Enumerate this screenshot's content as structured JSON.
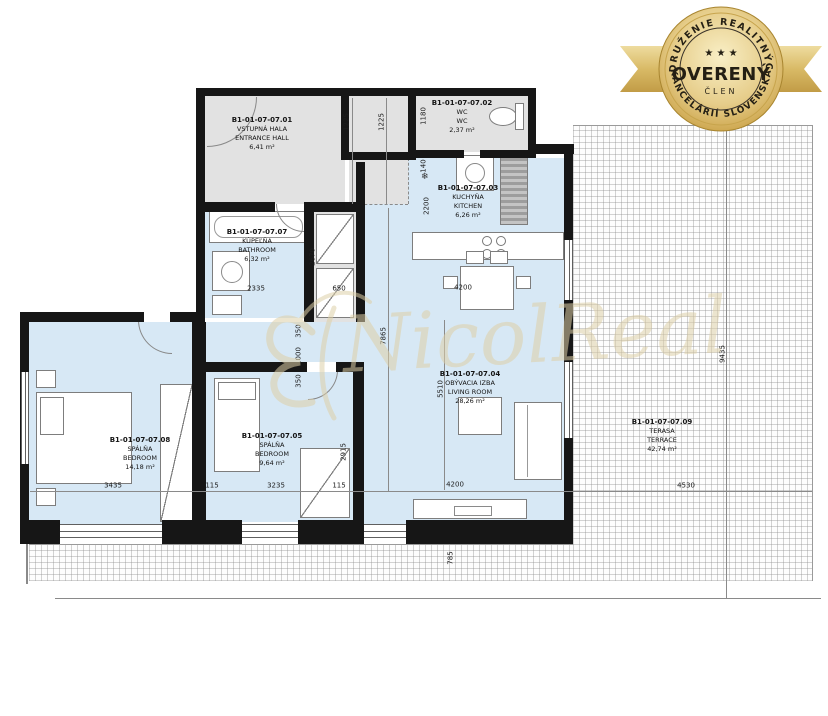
{
  "badge": {
    "arc_top": "ZDRUŽENIE REALITNÝCH",
    "arc_bottom": "KANCELÁRIÍ SLOVENSKA",
    "stars": "★ ★ ★",
    "title": "OVERENÝ",
    "subtitle": "ČLEN"
  },
  "watermark": {
    "text": "NicolReal"
  },
  "icons": {
    "fridge_snowflake": "❄"
  },
  "rooms": [
    {
      "code": "B1-01-07-07.01",
      "name_sk": "VSTUPNÁ HALA",
      "name_en": "ENTRANCE HALL",
      "area": "6,41 m²"
    },
    {
      "code": "B1-01-07-07.02",
      "name_sk": "WC",
      "name_en": "WC",
      "area": "2,37 m²"
    },
    {
      "code": "B1-01-07-07.03",
      "name_sk": "KUCHYŇA",
      "name_en": "KITCHEN",
      "area": "6,26 m²"
    },
    {
      "code": "B1-01-07-07.04",
      "name_sk": "OBÝVACIA IZBA",
      "name_en": "LIVING ROOM",
      "area": "28,26 m²"
    },
    {
      "code": "B1-01-07-07.05",
      "name_sk": "SPÁLŇA",
      "name_en": "BEDROOM",
      "area": "9,64 m²"
    },
    {
      "code": "B1-01-07-07.07",
      "name_sk": "KÚPEĽŇA",
      "name_en": "BATHROOM",
      "area": "6,32 m²"
    },
    {
      "code": "B1-01-07-07.08",
      "name_sk": "SPÁLŇA",
      "name_en": "BEDROOM",
      "area": "14,18 m²"
    },
    {
      "code": "B1-01-07-07.09",
      "name_sk": "TERASA",
      "name_en": "TERRACE",
      "area": "42,74 m²"
    }
  ],
  "dims": [
    "1225",
    "1225",
    "1180",
    "140",
    "2200",
    "2670",
    "2335",
    "650",
    "350",
    "1000",
    "350",
    "7865",
    "5510",
    "4200",
    "4200",
    "3435",
    "115",
    "3235",
    "115",
    "2915",
    "4530",
    "9435",
    "785"
  ],
  "colors": {
    "room_blue": "#d7e8f5",
    "room_gray": "#e2e2e2",
    "wall": "#161616",
    "badge_gold": "#d9b864",
    "watermark": "#ded0a8"
  }
}
